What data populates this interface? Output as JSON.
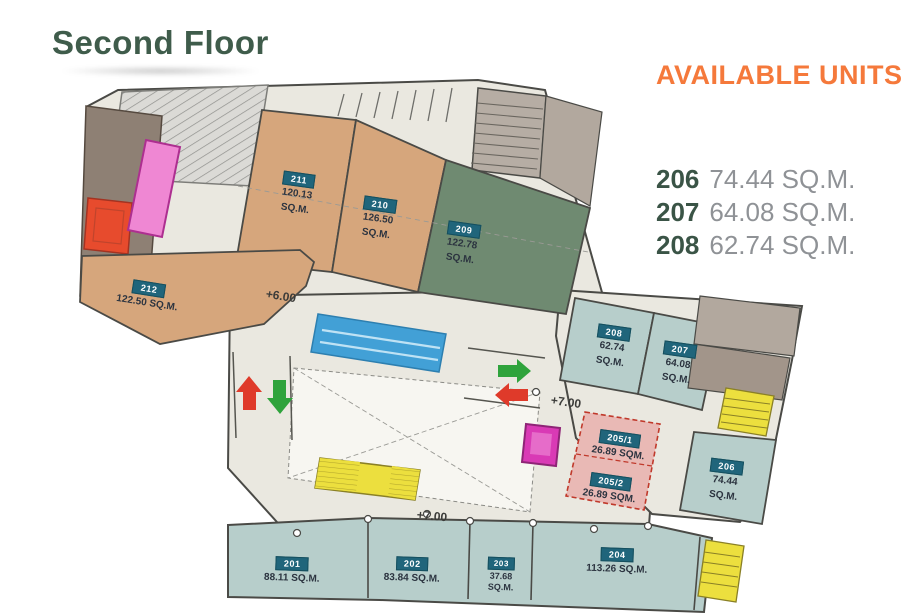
{
  "page": {
    "title": "Second Floor"
  },
  "available_units": {
    "heading": "AVAILABLE UNITS",
    "units": [
      {
        "number": "206",
        "area": "74.44 SQ.M."
      },
      {
        "number": "207",
        "area": "64.08 SQ.M."
      },
      {
        "number": "208",
        "area": "62.74 SQ.M."
      }
    ]
  },
  "floor_plan": {
    "levels": [
      "+6.00",
      "+7.00",
      "+7.00"
    ],
    "units": [
      {
        "number": "201",
        "lines": [
          "88.11 SQ.M."
        ]
      },
      {
        "number": "202",
        "lines": [
          "83.84 SQ.M."
        ]
      },
      {
        "number": "203",
        "lines": [
          "37.68",
          "SQ.M."
        ]
      },
      {
        "number": "204",
        "lines": [
          "113.26 SQ.M."
        ]
      },
      {
        "number": "205/1",
        "lines": [
          "26.89 SQM."
        ]
      },
      {
        "number": "205/2",
        "lines": [
          "26.89 SQM."
        ]
      },
      {
        "number": "206",
        "lines": [
          "74.44",
          "SQ.M."
        ]
      },
      {
        "number": "207",
        "lines": [
          "64.08",
          "SQ.M."
        ]
      },
      {
        "number": "208",
        "lines": [
          "62.74",
          "SQ.M."
        ]
      },
      {
        "number": "209",
        "lines": [
          "122.78",
          "SQ.M."
        ]
      },
      {
        "number": "210",
        "lines": [
          "126.50",
          "SQ.M."
        ]
      },
      {
        "number": "211",
        "lines": [
          "120.13",
          "SQ.M."
        ]
      },
      {
        "number": "212",
        "lines": [
          "122.50 SQ.M."
        ]
      }
    ],
    "icons": {
      "escalator_up": "red-up-arrow",
      "escalator_down": "green-down-arrow",
      "escalator_forward": "green-right-arrow",
      "escalator_back": "red-left-arrow"
    }
  },
  "colors": {
    "title_green": "#3f5c4b",
    "accent_orange": "#f5793b",
    "badge_teal": "#20657b",
    "unit_tan": "#d6a67c",
    "unit_green": "#6f8a71",
    "unit_teal": "#b7cecb",
    "unit_pink_dashed": "#e9b9b5",
    "stair_yellow": "#ecdf3e",
    "skylight_blue": "#42a0d6",
    "elevator_magenta": "#d93ab5",
    "service_taupe": "#8e8074",
    "floor_beige": "#eae8e0",
    "arrow_red": "#df3a2a",
    "arrow_green": "#2fa33c"
  }
}
